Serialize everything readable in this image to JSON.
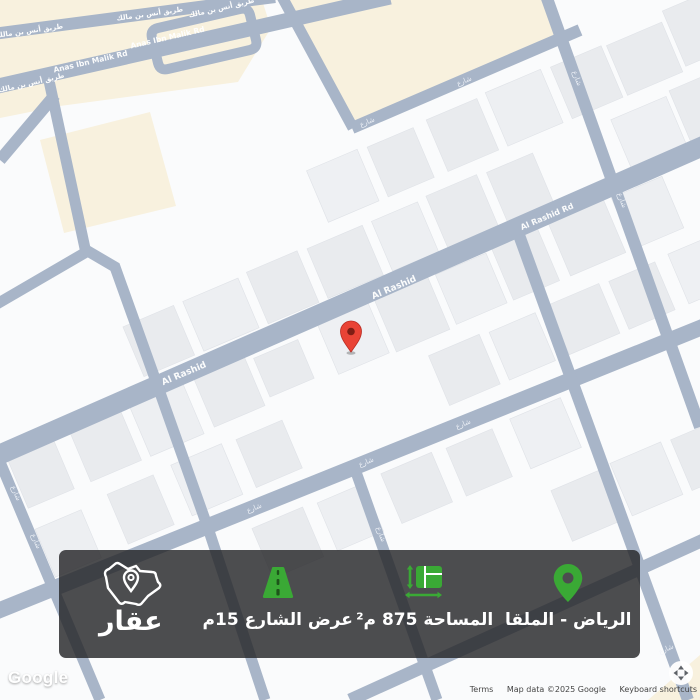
{
  "map": {
    "roads": {
      "anas_en": "Anas Ibn Malik Rd",
      "anas_ar": "طريق أنس بن مالك",
      "rashid": "Al Rashid",
      "rashid_rd": "Al Rashid Rd",
      "minor": "شارع"
    },
    "google_logo": "Google",
    "attribution": {
      "terms": "Terms",
      "map_data": "Map data ©2025 Google",
      "keyboard": "Keyboard shortcuts"
    },
    "colors": {
      "road": "#a8b5c8",
      "building": "#e9ebee",
      "commercial_area": "#f8f1de",
      "pin_red": "#e94335"
    }
  },
  "overlay": {
    "location_label": "الرياض - الملقا",
    "area_label": "المساحة 875 م²",
    "street_width_label": "عرض الشارع 15م",
    "logo_text": "عقار",
    "accent_green": "#3aa935"
  }
}
